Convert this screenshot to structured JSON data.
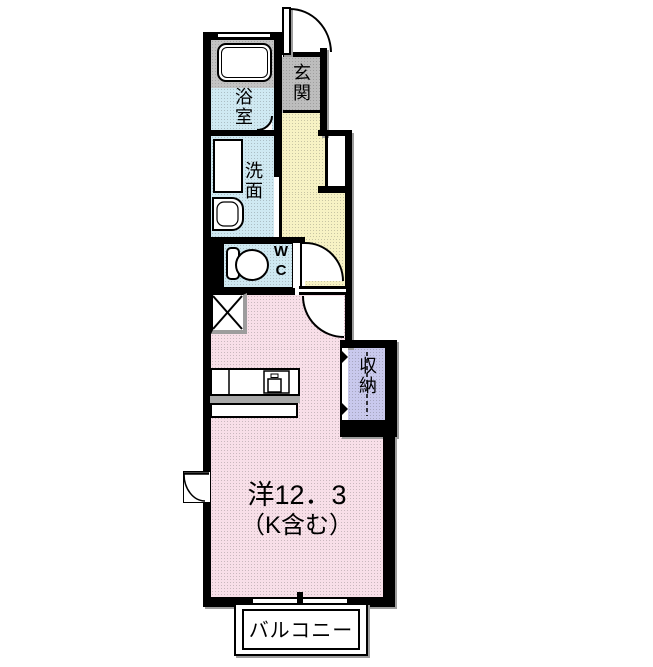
{
  "floorplan": {
    "rooms": {
      "bath": {
        "label": "浴室"
      },
      "washroom": {
        "label": "洗面"
      },
      "wc": {
        "line1": "W",
        "line2": "C"
      },
      "entrance": {
        "label": "玄関"
      },
      "storage": {
        "label": "収納"
      },
      "main_room": {
        "size_label": "洋12．3",
        "note_label": "（K含む）"
      },
      "balcony": {
        "label": "バルコニー"
      }
    },
    "colors": {
      "wall": "#000000",
      "bath-blue": "#cfe9f2",
      "hall-yellow": "#f7f2c4",
      "room-pink": "#f8dfe8",
      "storage-lavender": "#c9c9ed",
      "entrance-gray": "#bdbdbd",
      "tub-gray": "#c3c3c3",
      "counter-gray": "#a8a8a8",
      "shadow-gray": "#9d9d9d"
    }
  }
}
